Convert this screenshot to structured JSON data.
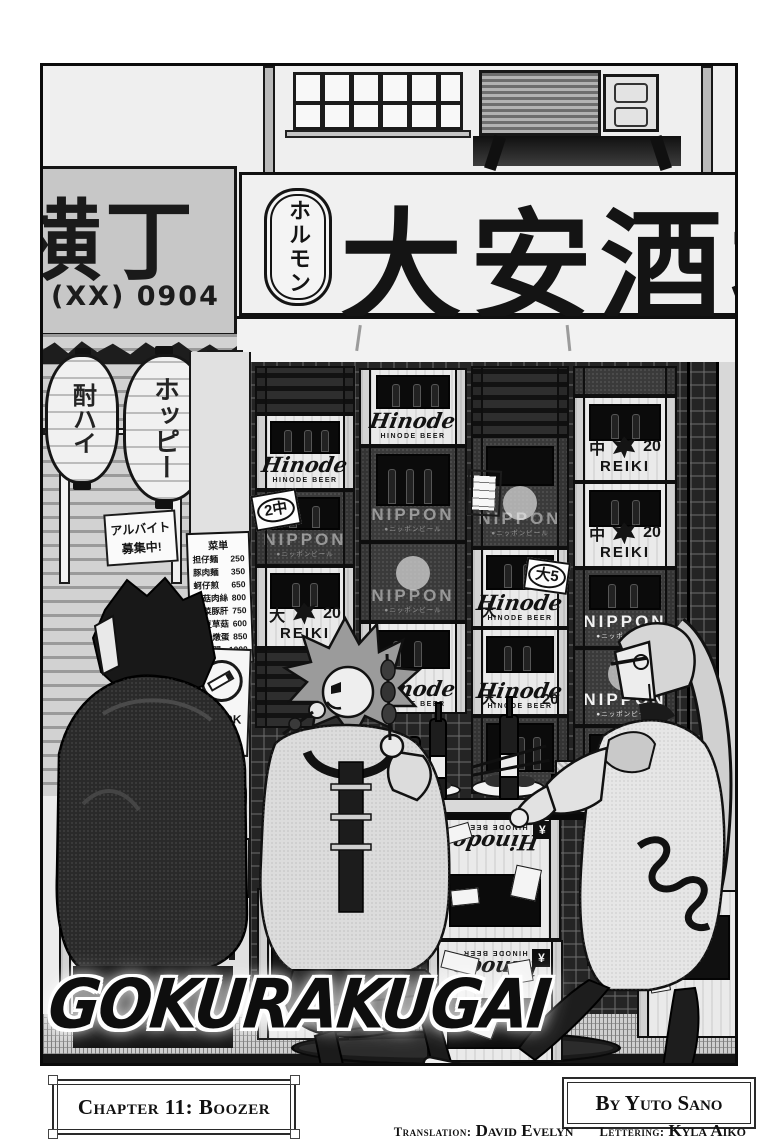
{
  "page": {
    "logo": "GOKURAKUGAI",
    "chapter_label": "Chapter 11: Boozer",
    "byline": "By Yuto Sano",
    "translation_label": "Translation:",
    "translation_name": "David Evelyn",
    "lettering_label": "Lettering:",
    "lettering_name": "Kyla Aiko"
  },
  "storefront": {
    "main_sign_text": "大安酒場",
    "main_sign_badge": "ホルモン",
    "alley_sign_text": "横丁",
    "alley_sign_phone": "(XX) 0904",
    "lantern_left_text": "酎ハイ",
    "lantern_right_text": "ホッピー",
    "hiring_line1": "アルバイト",
    "hiring_line2": "募集中!",
    "smoking_sign_text": "喫煙OK",
    "payment_line1": "お会計は",
    "payment_line2": "コチラ",
    "payment_arrow": "⇨",
    "tag_2chu": "2中",
    "tag_dai5": "大5"
  },
  "menu_board": {
    "title": "菜単",
    "items": [
      {
        "name": "担仔麺",
        "price": "250"
      },
      {
        "name": "豚肉麺",
        "price": "350"
      },
      {
        "name": "蚵仔煎",
        "price": "650"
      },
      {
        "name": "草菇肉絲",
        "price": "800"
      },
      {
        "name": "韮菜豚肝",
        "price": "750"
      },
      {
        "name": "敏豆草菇",
        "price": "600"
      },
      {
        "name": "蟹肉燉蛋",
        "price": "850"
      },
      {
        "name": "五更腸旺",
        "price": "1000"
      }
    ]
  },
  "crates": {
    "hinode_name": "Hinode",
    "hinode_sub": "HINODE BEER",
    "nippon_name": "NIPPON",
    "nippon_sub": "●ニッポンビール",
    "reiki_name": "REIKI",
    "size_medium": "中",
    "size_large": "大",
    "count": "20",
    "yen": "¥"
  }
}
